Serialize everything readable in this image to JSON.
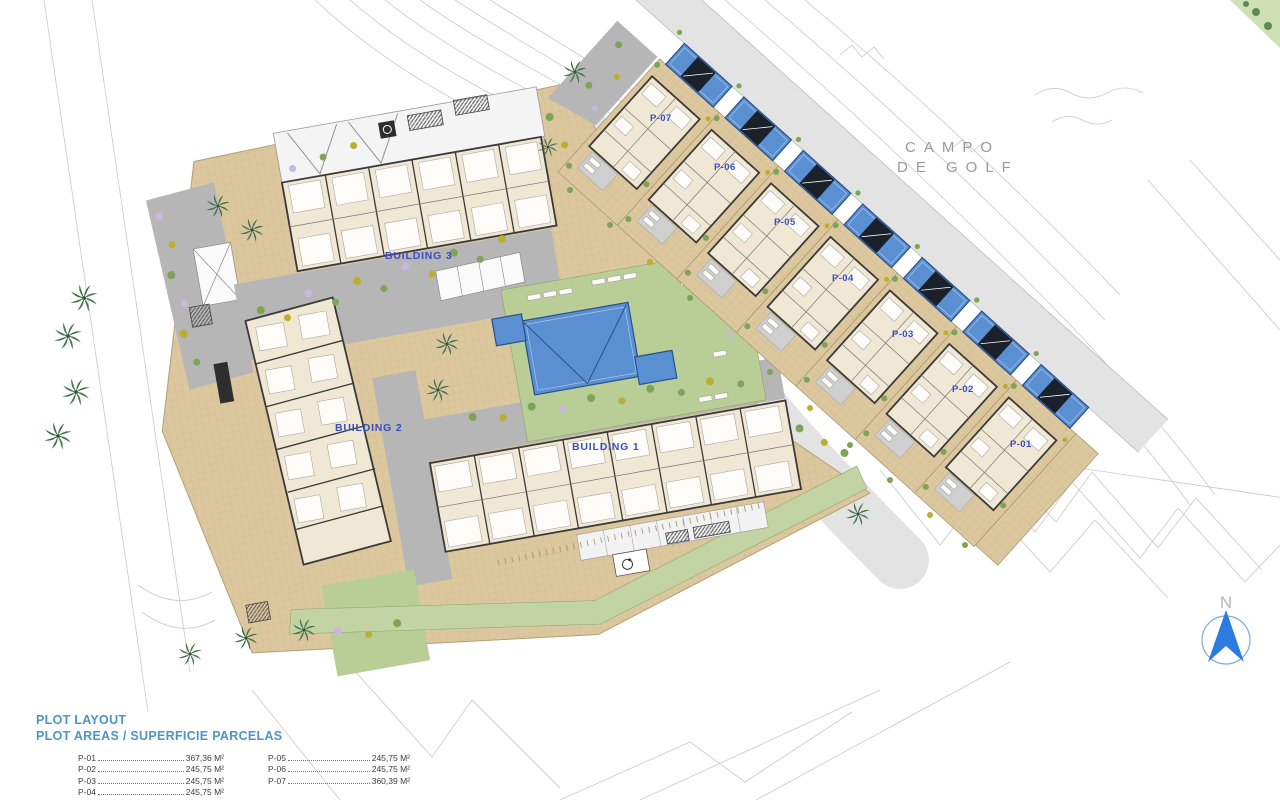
{
  "site": {
    "golf_label_line1": "CAMPO",
    "golf_label_line2": "DE GOLF",
    "compass_label": "N"
  },
  "buildings": [
    {
      "label": "BUILDING 3"
    },
    {
      "label": "BUILDING 2"
    },
    {
      "label": "BUILDING 1"
    }
  ],
  "plots": {
    "labels": [
      "P-07",
      "P-06",
      "P-05",
      "P-04",
      "P-03",
      "P-02",
      "P-01"
    ]
  },
  "legend": {
    "title": "PLOT LAYOUT",
    "subtitle": "PLOT AREAS / SUPERFICIE PARCELAS",
    "items": [
      {
        "label": "P-01",
        "value": "367,36 M²"
      },
      {
        "label": "P-02",
        "value": "245,75 M²"
      },
      {
        "label": "P-03",
        "value": "245,75 M²"
      },
      {
        "label": "P-04",
        "value": "245,75 M²"
      },
      {
        "label": "P-05",
        "value": "245,75 M²"
      },
      {
        "label": "P-06",
        "value": "245,75 M²"
      },
      {
        "label": "P-07",
        "value": "360,39 M²"
      }
    ]
  },
  "colors": {
    "paving-tan": "#dcc79f",
    "lawn-green": "#b9cd97",
    "band-green": "#c3d4a4",
    "path-gray": "#b6b6b6",
    "road-gray": "#e3e3e3",
    "pool-blue": "#5a8fd1",
    "pool-dark": "#27508e",
    "pergola-dark": "#1b212b",
    "building-cream": "#f0e8d4",
    "wall-dark": "#3a3a3a",
    "label-blue": "#3a4ec0",
    "legend-blue": "#4d94c8",
    "golf-gray": "#9a9a9a",
    "contour-gray": "#c9c9c9",
    "compass-blue": "#2c7be0",
    "palm-green": "#44704d",
    "bush-green": "#7da457",
    "bush-yellow": "#bcae2f",
    "bush-purple": "#c9b7dd"
  }
}
